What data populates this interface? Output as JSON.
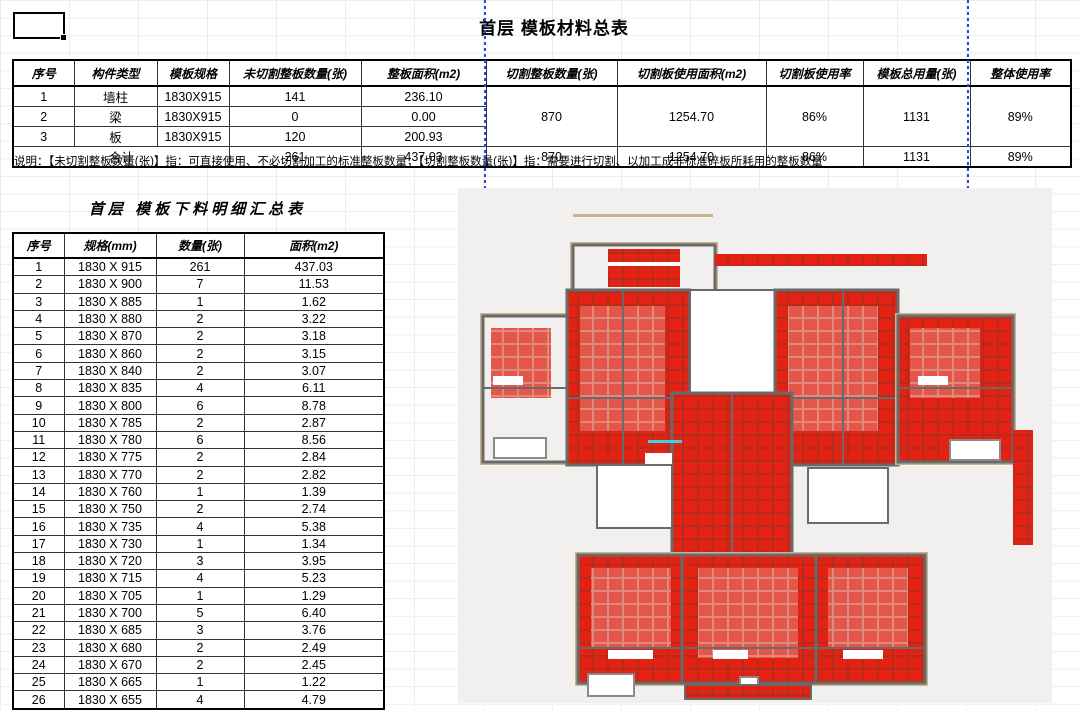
{
  "summary": {
    "title": "首层 模板材料总表",
    "headers": [
      "序号",
      "构件类型",
      "模板规格",
      "未切割整板数量(张)",
      "整板面积(m2)",
      "切割整板数量(张)",
      "切割板使用面积(m2)",
      "切割板使用率",
      "模板总用量(张)",
      "整体使用率"
    ],
    "rows": [
      [
        "1",
        "墙柱",
        "1830X915",
        "141",
        "236.10"
      ],
      [
        "2",
        "梁",
        "1830X915",
        "0",
        "0.00"
      ],
      [
        "3",
        "板",
        "1830X915",
        "120",
        "200.93"
      ]
    ],
    "merged": {
      "cut_count": "870",
      "cut_area": "1254.70",
      "cut_rate": "86%",
      "total_count": "1131",
      "overall_rate": "89%"
    },
    "total_row": {
      "label": "合计",
      "uncut_count": "261",
      "area": "437.03",
      "cut_count": "870",
      "cut_area": "1254.70",
      "cut_rate": "86%",
      "total_count": "1131",
      "overall_rate": "89%"
    }
  },
  "note": "说明：【未切割整板数量(张)】指：可直接使用、不必切割加工的标准整板数量；【切割整板数量(张)】指：需要进行切割、以加工成非标准碎板所耗用的整板数量",
  "detail": {
    "title": "首层 模板下料明细汇总表",
    "headers": [
      "序号",
      "规格(mm)",
      "数量(张)",
      "面积(m2)"
    ],
    "rows": [
      [
        "1",
        "1830 X 915",
        "261",
        "437.03"
      ],
      [
        "2",
        "1830 X 900",
        "7",
        "11.53"
      ],
      [
        "3",
        "1830 X 885",
        "1",
        "1.62"
      ],
      [
        "4",
        "1830 X 880",
        "2",
        "3.22"
      ],
      [
        "5",
        "1830 X 870",
        "2",
        "3.18"
      ],
      [
        "6",
        "1830 X 860",
        "2",
        "3.15"
      ],
      [
        "7",
        "1830 X 840",
        "2",
        "3.07"
      ],
      [
        "8",
        "1830 X 835",
        "4",
        "6.11"
      ],
      [
        "9",
        "1830 X 800",
        "6",
        "8.78"
      ],
      [
        "10",
        "1830 X 785",
        "2",
        "2.87"
      ],
      [
        "11",
        "1830 X 780",
        "6",
        "8.56"
      ],
      [
        "12",
        "1830 X 775",
        "2",
        "2.84"
      ],
      [
        "13",
        "1830 X 770",
        "2",
        "2.82"
      ],
      [
        "14",
        "1830 X 760",
        "1",
        "1.39"
      ],
      [
        "15",
        "1830 X 750",
        "2",
        "2.74"
      ],
      [
        "16",
        "1830 X 735",
        "4",
        "5.38"
      ],
      [
        "17",
        "1830 X 730",
        "1",
        "1.34"
      ],
      [
        "18",
        "1830 X 720",
        "3",
        "3.95"
      ],
      [
        "19",
        "1830 X 715",
        "4",
        "5.23"
      ],
      [
        "20",
        "1830 X 705",
        "1",
        "1.29"
      ],
      [
        "21",
        "1830 X 700",
        "5",
        "6.40"
      ],
      [
        "22",
        "1830 X 685",
        "3",
        "3.76"
      ],
      [
        "23",
        "1830 X 680",
        "2",
        "2.49"
      ],
      [
        "24",
        "1830 X 670",
        "2",
        "2.45"
      ],
      [
        "25",
        "1830 X 665",
        "1",
        "1.22"
      ],
      [
        "26",
        "1830 X 655",
        "4",
        "4.79"
      ]
    ]
  },
  "plan": {
    "description": "首层模板平面布置图（红色为模板面板）",
    "colors": {
      "panel_red": "#e32213",
      "panel_grout": "#b72b1c",
      "panel_salmon": "#e4554a",
      "panel_salmon_grout": "#e08a7d",
      "wall_gray": "#6a6a6a",
      "trim_tan": "#c9b28e",
      "plan_bg": "#f1f0ee",
      "accent_cyan": "#3fd0e4",
      "pagebreak_blue": "#2b46e0"
    }
  }
}
